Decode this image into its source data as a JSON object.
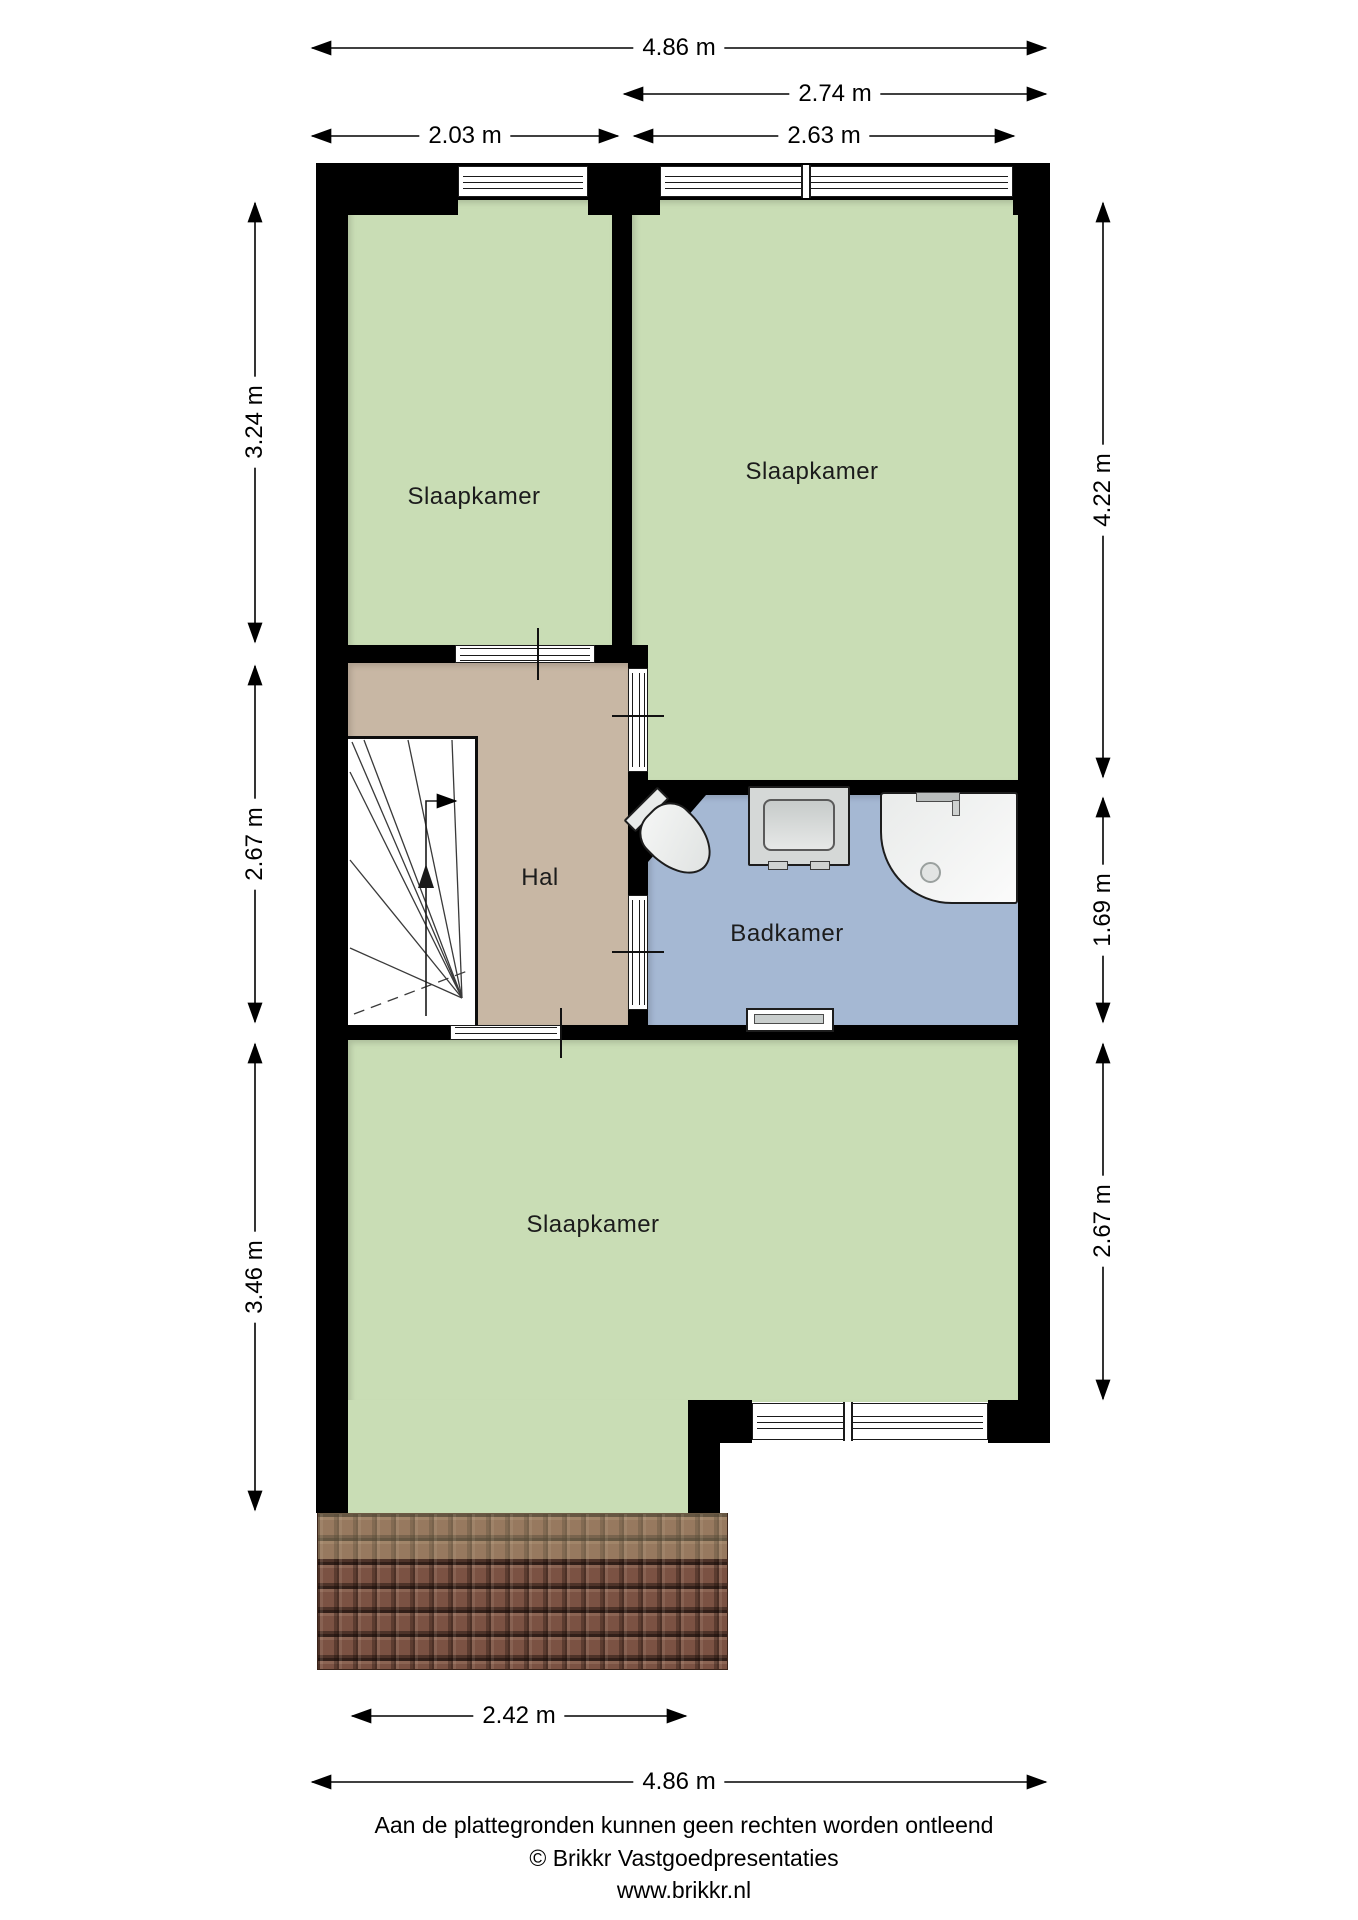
{
  "plan": {
    "type": "floorplan-first-floor",
    "room_labels": {
      "bedroom_top_left": "Slaapkamer",
      "bedroom_top_right": "Slaapkamer",
      "hall": "Hal",
      "bathroom": "Badkamer",
      "bedroom_bottom": "Slaapkamer"
    },
    "fixtures": [
      "stairs",
      "toilet",
      "sink",
      "shower",
      "radiator"
    ],
    "colors": {
      "room_green": "#c9ddb5",
      "hall_tan": "#c8b7a4",
      "bathroom_blue": "#a5b8d3",
      "wall_black": "#000000",
      "roof_brown": "#7b5243"
    }
  },
  "dims": {
    "top_total": "4.86 m",
    "top_right": "2.74 m",
    "top_left_inner": "2.03 m",
    "top_right_inner": "2.63 m",
    "left_top": "3.24 m",
    "left_middle": "2.67 m",
    "left_bottom": "3.46 m",
    "right_top": "4.22 m",
    "right_middle": "1.69 m",
    "right_bottom": "2.67 m",
    "bottom_inner": "2.42 m",
    "bottom_total": "4.86 m"
  },
  "footer": {
    "disclaimer": "Aan de plattegronden kunnen geen rechten worden ontleend",
    "copyright": "© Brikkr Vastgoedpresentaties",
    "website": "www.brikkr.nl"
  }
}
